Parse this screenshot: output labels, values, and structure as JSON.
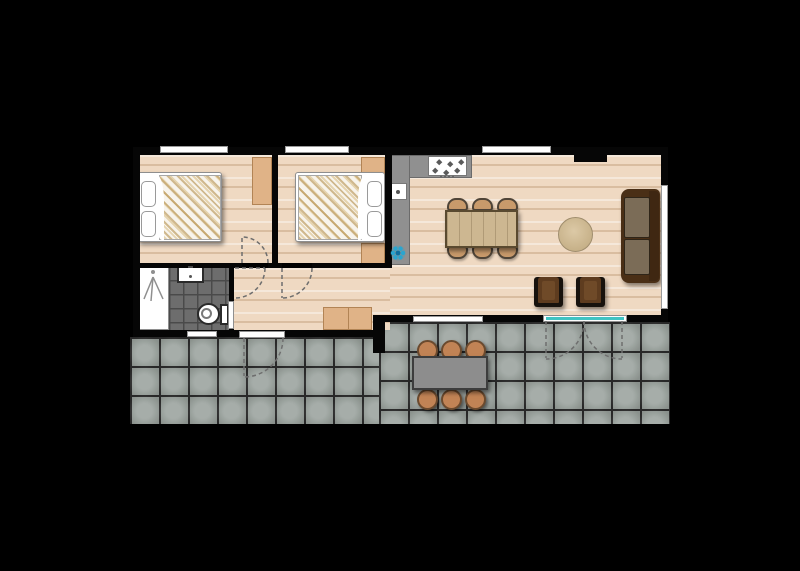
{
  "image": {
    "kind": "architectural-floor-plan",
    "description_label": "holiday-home-floor-plan-with-terrace"
  },
  "colors": {
    "background": "#000000",
    "wall": "#060606",
    "wood_floor": "#efd9c2",
    "terrace_tile": "#9aa29d",
    "terrace_grout": "#2c2c2c",
    "bath_tile": "#6d6d6d",
    "bath_grout": "#4a4a4a",
    "counter": "#909090",
    "sink_teal": "#2aa5cf",
    "window_glass_teal": "#3fc3c3",
    "window_white": "#ffffff",
    "cabinet_tan": "#e0b387",
    "table_wood": "#cdb791",
    "chair_tan": "#c89a6b",
    "outdoor_chair": "#c18355",
    "outdoor_table": "#8d8d8d",
    "sofa_frame": "#4a2f16",
    "sofa_cushion": "#7b6c57",
    "armchair": "#5e3c1f",
    "rug": "#c4ae85",
    "door_dash": "#6e6e6e"
  },
  "plan": {
    "rooms": [
      {
        "name": "bedroom-1",
        "furniture": [
          "double-bed",
          "two-pillows",
          "wardrobe"
        ],
        "openings": [
          "top-window",
          "swing-door"
        ]
      },
      {
        "name": "bedroom-2",
        "furniture": [
          "double-bed",
          "two-pillows",
          "wardrobe-top",
          "wardrobe-bottom"
        ],
        "openings": [
          "top-window",
          "swing-door"
        ]
      },
      {
        "name": "bathroom",
        "furniture": [
          "shower",
          "washbasin",
          "toilet"
        ],
        "openings": [
          "bottom-window",
          "swing-door"
        ]
      },
      {
        "name": "hallway",
        "furniture": [
          "storage-cabinet"
        ],
        "openings": [
          "entrance-door-to-terrace"
        ]
      },
      {
        "name": "kitchen",
        "furniture": [
          "l-shaped-counter",
          "hob-4-burners",
          "hotplate-unit",
          "round-sink"
        ],
        "openings": []
      },
      {
        "name": "living-dining-room",
        "furniture": [
          "dining-table",
          "six-dining-chairs",
          "round-rug",
          "two-seat-sofa",
          "two-armchairs"
        ],
        "openings": [
          "top-window",
          "right-window",
          "bottom-window",
          "double-patio-door"
        ]
      },
      {
        "name": "terrace",
        "furniture": [
          "outdoor-table",
          "six-outdoor-chairs"
        ],
        "openings": []
      }
    ]
  }
}
